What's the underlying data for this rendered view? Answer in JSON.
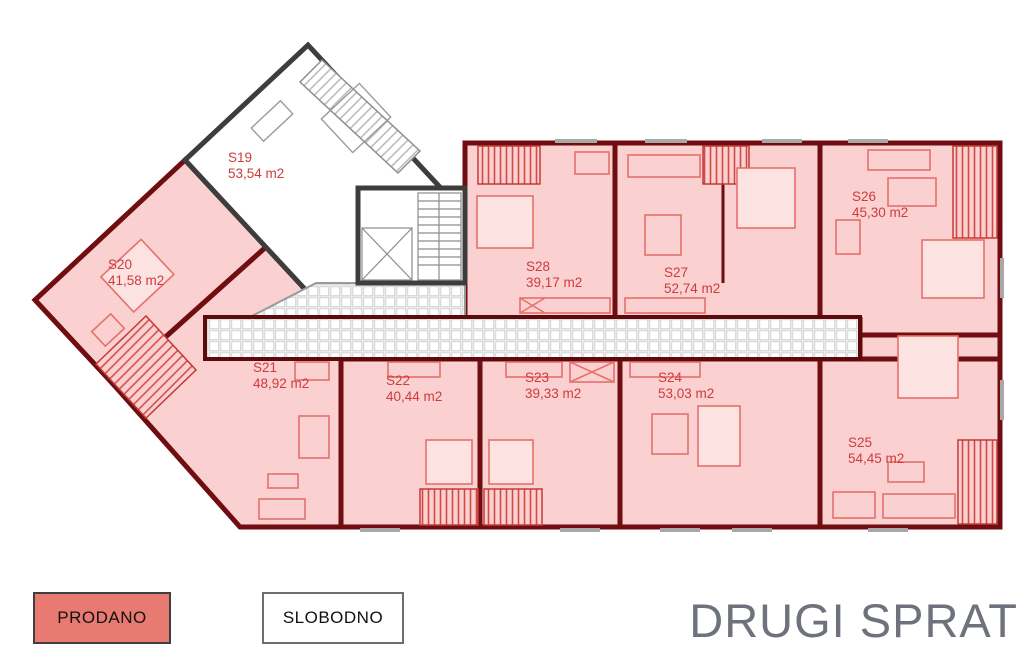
{
  "title": {
    "text": "DRUGI SPRAT",
    "color": "#6d727c"
  },
  "legend": {
    "sold": {
      "label": "PRODANO",
      "fill": "#e87a72"
    },
    "free": {
      "label": "SLOBODNO",
      "fill": "#ffffff"
    }
  },
  "plan": {
    "sold_fill": "#fbd0d0",
    "free_fill": "#ffffff",
    "sold_wall": "#6f0d10",
    "free_wall": "#3d3d3d",
    "label_color": "#cf3b3b"
  },
  "apartments": [
    {
      "id": "S19",
      "area": "53,54 m2",
      "status": "slobodno"
    },
    {
      "id": "S20",
      "area": "41,58 m2",
      "status": "prodano"
    },
    {
      "id": "S21",
      "area": "48,92 m2",
      "status": "prodano"
    },
    {
      "id": "S22",
      "area": "40,44 m2",
      "status": "prodano"
    },
    {
      "id": "S23",
      "area": "39,33 m2",
      "status": "prodano"
    },
    {
      "id": "S24",
      "area": "53,03 m2",
      "status": "prodano"
    },
    {
      "id": "S25",
      "area": "54,45 m2",
      "status": "prodano"
    },
    {
      "id": "S26",
      "area": "45,30 m2",
      "status": "prodano"
    },
    {
      "id": "S27",
      "area": "52,74 m2",
      "status": "prodano"
    },
    {
      "id": "S28",
      "area": "39,17 m2",
      "status": "prodano"
    }
  ]
}
